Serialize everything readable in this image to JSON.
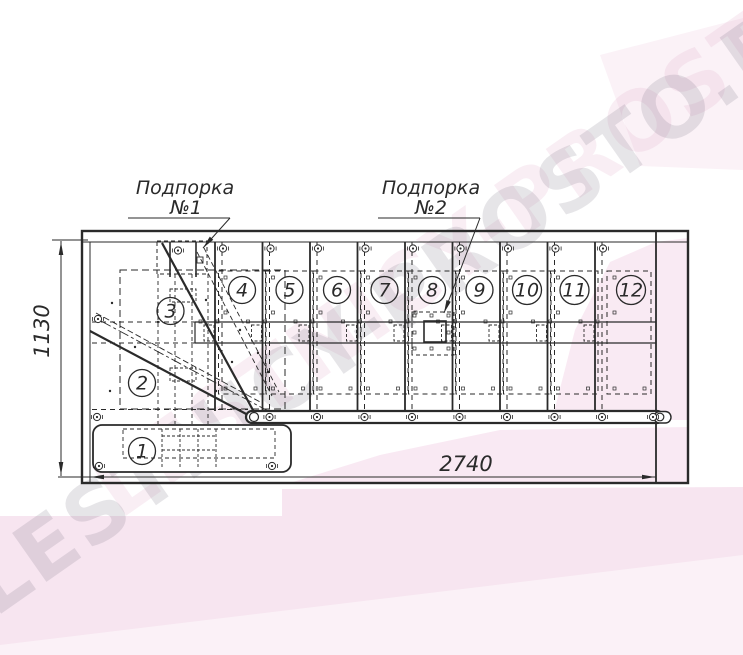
{
  "watermark": {
    "text": "LESTNICY-PROSTO.RU"
  },
  "callouts": {
    "support1": {
      "title": "Подпорка",
      "number": "№1"
    },
    "support2": {
      "title": "Подпорка",
      "number": "№2"
    }
  },
  "dimensions": {
    "length_mm": "2740",
    "height_mm": "1130"
  },
  "steps": [
    "1",
    "2",
    "3",
    "4",
    "5",
    "6",
    "7",
    "8",
    "9",
    "10",
    "11",
    "12"
  ],
  "colors": {
    "line": "#2a2a2a",
    "watermark_gray": "#696275",
    "watermark_pink": "#dfa8c8",
    "pink_tint_1": "#f7e5f0",
    "pink_tint_2": "#f9e9f3",
    "pink_tint_3": "#f9eaf3",
    "pink_tint_4": "#fbf2f7",
    "pink_tint_5": "#fcf3f8"
  }
}
